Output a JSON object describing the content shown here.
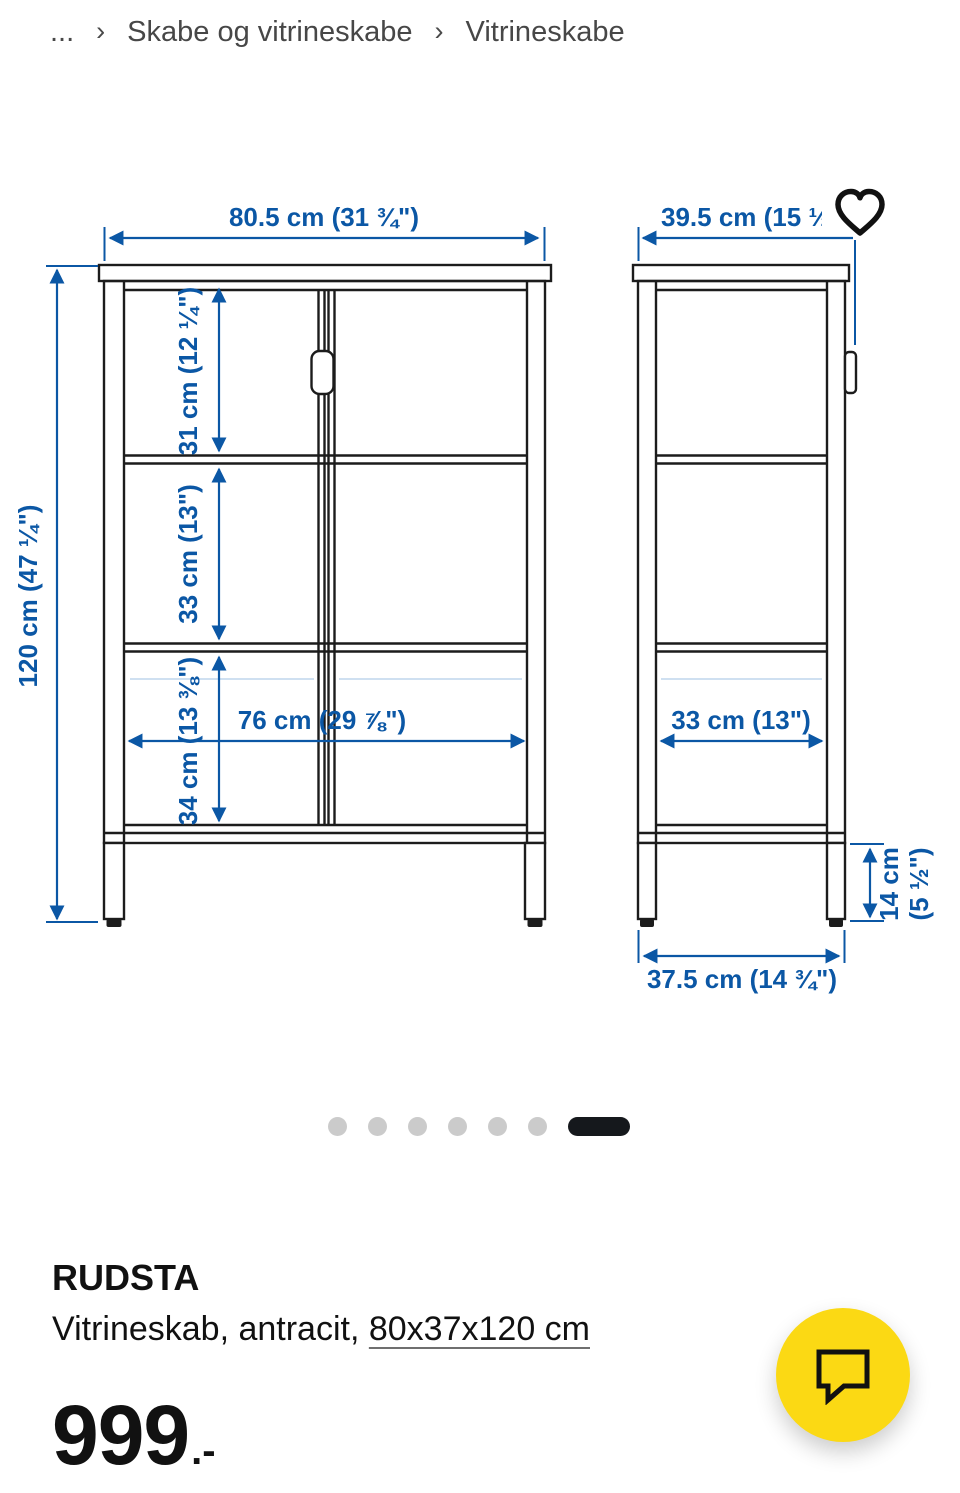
{
  "breadcrumb": {
    "collapsed": "...",
    "separator": "›",
    "items": [
      {
        "label": "Skabe og vitrineskabe"
      },
      {
        "label": "Vitrineskabe"
      }
    ]
  },
  "diagram": {
    "front_view": {
      "overall_width": "80.5 cm (31 ¾\")",
      "overall_height": "120 cm (47 ¼\")",
      "top_section_height": "31 cm (12 ¼\")",
      "middle_section_height": "33 cm (13\")",
      "bottom_section_height": "34 cm (13 ⅜\")",
      "interior_width": "76 cm (29 ⅞\")"
    },
    "side_view": {
      "overall_depth": "39.5 cm (15 ½",
      "interior_depth": "33 cm (13\")",
      "leg_height_line1": "14 cm",
      "leg_height_line2": "(5 ½\")",
      "base_depth": "37.5 cm (14 ¾\")"
    }
  },
  "carousel": {
    "inactive_dots": 6,
    "active_dot_position": 7
  },
  "product": {
    "name": "RUDSTA",
    "description_prefix": "Vitrineskab, antracit, ",
    "dimensions_link": "80x37x120 cm",
    "price": "999",
    "price_suffix": ".-"
  },
  "icons": {
    "favorite": "heart-icon",
    "chat": "chat-bubble-icon"
  },
  "colors": {
    "dimension_blue": "#0b57a5",
    "drawing_line": "#1c1c1c",
    "accent_yellow": "#fbd914",
    "dot_gray": "#cbcbcb",
    "active_dot": "#15181c"
  }
}
